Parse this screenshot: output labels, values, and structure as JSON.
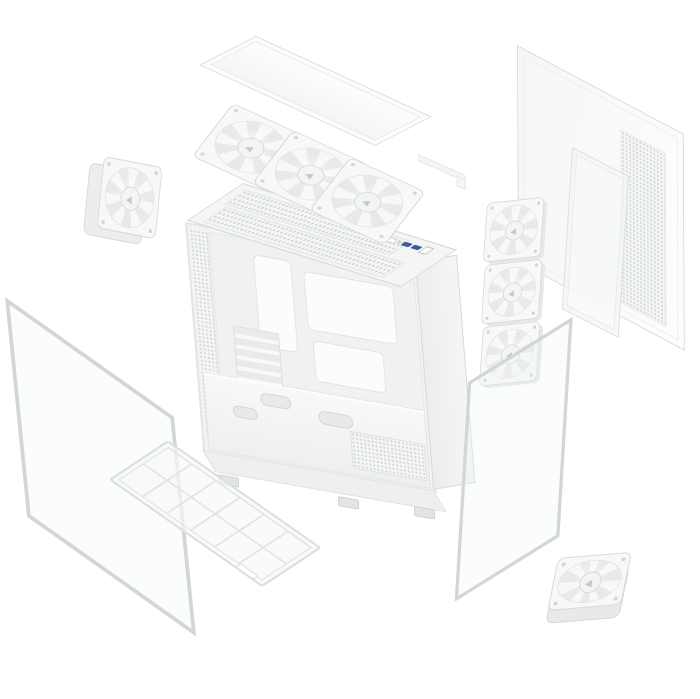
{
  "image": {
    "type": "product-render",
    "subject": "Exploded view of a white mid-tower PC case with fans, panels and dust filters",
    "background": "#ffffff"
  },
  "colors": {
    "bg": "#ffffff",
    "fill": "#f7f8f8",
    "border": "#d6d9da",
    "borderSoft": "#e4e6e7",
    "mesh": "#d4d7d8",
    "glass": "rgba(242,244,245,0.30)",
    "glassEdge": "#d3d6d7",
    "usbBlue": "#41589f",
    "blade": "#e7e9ea",
    "bladeLight": "#f7f8f8",
    "hub": "#f3f4f5",
    "shadow": "#e6e8e9"
  },
  "components": {
    "glass_front": {
      "label": "Tempered glass front panel (empty frame outline, lower left)"
    },
    "top_panel": {
      "label": "Solid top cover panel"
    },
    "mount_bracket": {
      "label": "Small mounting bracket"
    },
    "rear_fan": {
      "label": "Rear exhaust 120 mm fan"
    },
    "side_panel": {
      "label": "Steel side panel with perforated vent strip"
    },
    "side_filter": {
      "label": "Side dust filter strip"
    },
    "chassis": {
      "label": "Main chassis frame with motherboard tray and PSU shroud"
    },
    "io_panel": {
      "label": "Top front I/O: audio jack, LED, 2 blue USB-A ports, power button",
      "usb_count": 2
    },
    "pcie": {
      "label": "PCIe expansion slot covers"
    },
    "psu_vent": {
      "label": "Perforated PSU mount"
    },
    "top_fans": {
      "label": "Row of three 120 mm top fans",
      "count": 3
    },
    "side_fans": {
      "label": "Stack of three 120 mm side intake fans",
      "count": 3
    },
    "glass_side": {
      "label": "Tempered glass side panel (empty frame outline, right)"
    },
    "bottom_filter": {
      "label": "Bottom dust filter with 2 x 6 grid",
      "grid": "2x6"
    },
    "bottom_fan": {
      "label": "Bottom 120 mm fan"
    }
  }
}
